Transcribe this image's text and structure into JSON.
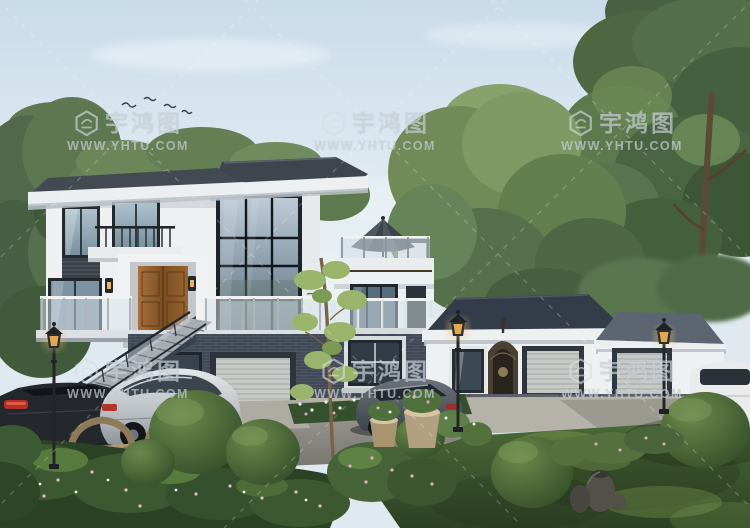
{
  "meta": {
    "kind": "3D architectural exterior rendering",
    "subject": "Two-storey modern white villa with dark hip roofs, roof terrace with umbrella, stone entrance stairs, attached single-storey garage wing, landscaped garden, driveway with parked cars and ornate garden lamps",
    "width": 750,
    "height": 528
  },
  "watermark": {
    "brand": "宇鸿图",
    "website": "WWW.YHTU.COM",
    "logo_icon": "yhtu-hexagon-logo",
    "tiles": [
      {
        "x": 128,
        "y": 131
      },
      {
        "x": 375,
        "y": 131
      },
      {
        "x": 622,
        "y": 131
      },
      {
        "x": 128,
        "y": 379
      },
      {
        "x": 375,
        "y": 379
      },
      {
        "x": 622,
        "y": 379
      }
    ]
  },
  "scene_elements": [
    "sky",
    "clouds",
    "birds",
    "pine-trees-left",
    "large-tree-canopy-right",
    "background-trees",
    "main-house",
    "glass-curtain-wall",
    "wooden-entrance-door",
    "balcony-railing",
    "roof-terrace-umbrella",
    "basement-garage-door",
    "entrance-stairs",
    "garage-wing",
    "ornate-gate",
    "garage-doors",
    "garden-lamps",
    "dark-sedan",
    "silver-sedan",
    "grey-audi-sedan",
    "white-suv",
    "topiary-bushes",
    "flower-beds",
    "clay-pots",
    "metal-planters",
    "patio-deck-furniture",
    "slender-tree",
    "lawn",
    "driveway"
  ],
  "palette": {
    "sky_top": "#c9dcea",
    "sky_bottom": "#eaf1f5",
    "wall_white": "#eff0f1",
    "roof_dark": "#3e454d",
    "roof_navy": "#343b49",
    "roof_grey": "#5d6572",
    "window_frame": "#22272e",
    "glass": "#a9bcc9",
    "door_wood": "#96622f",
    "basement_brick": "#424956",
    "driveway_asphalt": "#8f8d87",
    "concrete": "#b5b2aa",
    "grass": "#3f5c33",
    "bush": "#47603a",
    "tree_green": "#56714a",
    "lamp_glow": "#d99b3f",
    "watermark_text": "#d5dde3"
  }
}
